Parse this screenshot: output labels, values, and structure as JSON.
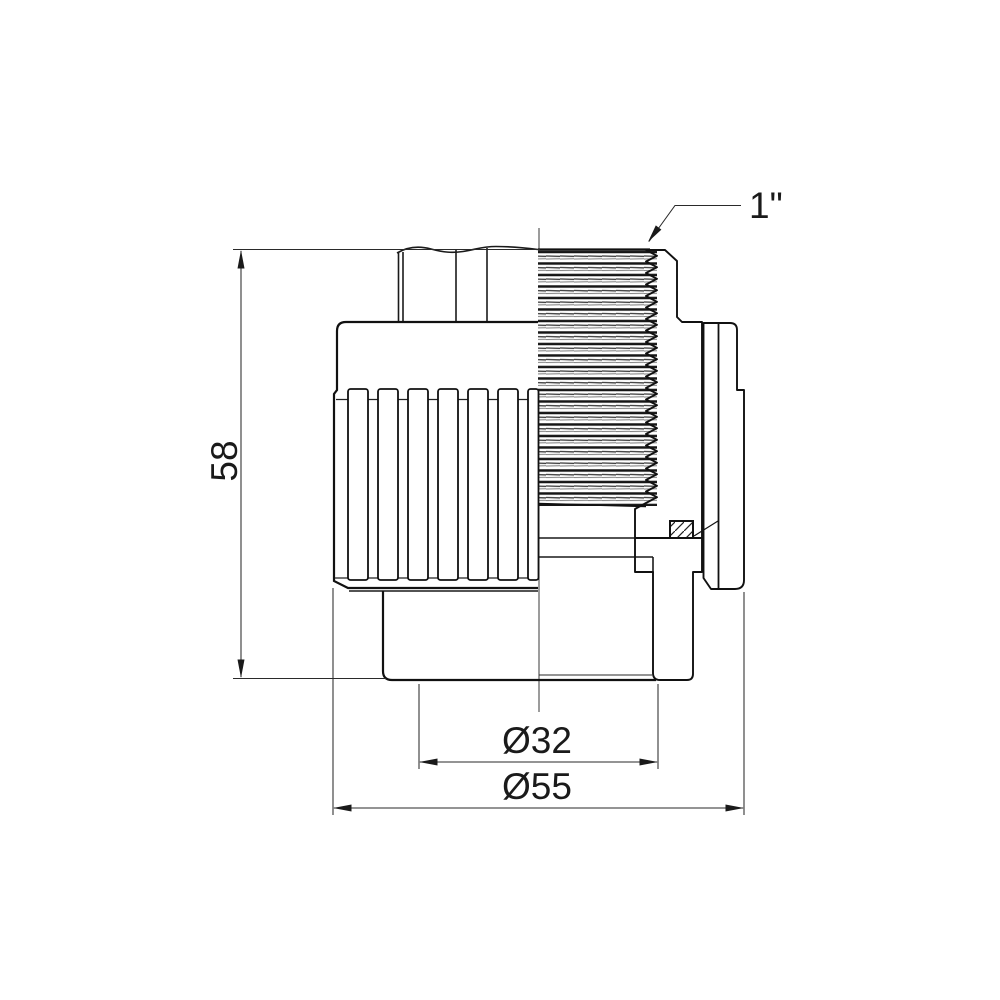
{
  "drawing": {
    "type": "technical-drawing",
    "subject": "threaded pipe fitting, half-section front view",
    "labels": {
      "height": "58",
      "socket_diameter": "Ø32",
      "body_diameter": "Ø55",
      "thread_size": "1\""
    },
    "colors": {
      "line": "#1a1a1a",
      "background": "#ffffff"
    }
  }
}
